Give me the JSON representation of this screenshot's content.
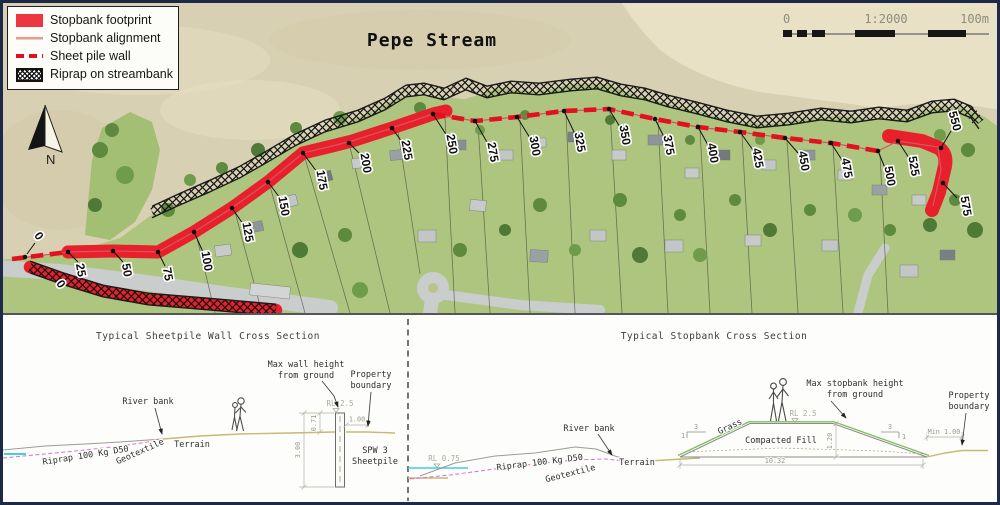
{
  "map": {
    "title": "Pepe Stream",
    "legend": {
      "items": [
        {
          "label": "Stopbank footprint"
        },
        {
          "label": "Stopbank alignment"
        },
        {
          "label": "Sheet pile wall"
        },
        {
          "label": "Riprap on streambank"
        }
      ]
    },
    "north_label": "N",
    "scale": {
      "left": "0",
      "ratio": "1:2000",
      "right": "100m"
    },
    "chainage": [
      "0",
      "25",
      "50",
      "75",
      "100",
      "125",
      "150",
      "175",
      "200",
      "225",
      "250",
      "275",
      "300",
      "325",
      "350",
      "375",
      "400",
      "425",
      "450",
      "475",
      "500",
      "525",
      "550",
      "575"
    ],
    "branch_chainage": "0",
    "colors": {
      "stopbank_red": "#e8202c",
      "alignment_red": "#d4575e",
      "sheetpile_red": "#e3111f",
      "water_cyan": "#45cede",
      "grass_green": "#7bbf58",
      "geotextile_magenta": "#e06ec8",
      "terrain_olive": "#c6ba74"
    }
  },
  "sections": {
    "sheetpile": {
      "title": "Typical Sheetpile Wall Cross Section",
      "river_bank": "River bank",
      "terrain": "Terrain",
      "riprap": "Riprap 100 Kg D50",
      "geotextile": "Geotextile",
      "max_height_line1": "Max wall height",
      "max_height_line2": "from ground",
      "property_line1": "Property",
      "property_line2": "boundary",
      "rl": "RL 2.5",
      "dim_exposed": "0.71",
      "dim_embed": "3.00",
      "dim_offset": "1.00",
      "wall_line1": "SPW 3",
      "wall_line2": "Sheetpile"
    },
    "stopbank": {
      "title": "Typical Stopbank Cross Section",
      "rl_water": "RL 0.75",
      "river_bank": "River bank",
      "riprap": "Riprap 100 Kg D50",
      "geotextile": "Geotextile",
      "terrain": "Terrain",
      "grass": "Grass",
      "fill": "Compacted Fill",
      "rl_crest": "RL 2.5",
      "max_height_line1": "Max stopbank height",
      "max_height_line2": "from ground",
      "property_line1": "Property",
      "property_line2": "boundary",
      "dim_width": "10.32",
      "dim_height": "1.20",
      "dim_min": "Min 1.00",
      "slope_run": "3",
      "slope_rise": "1"
    }
  }
}
